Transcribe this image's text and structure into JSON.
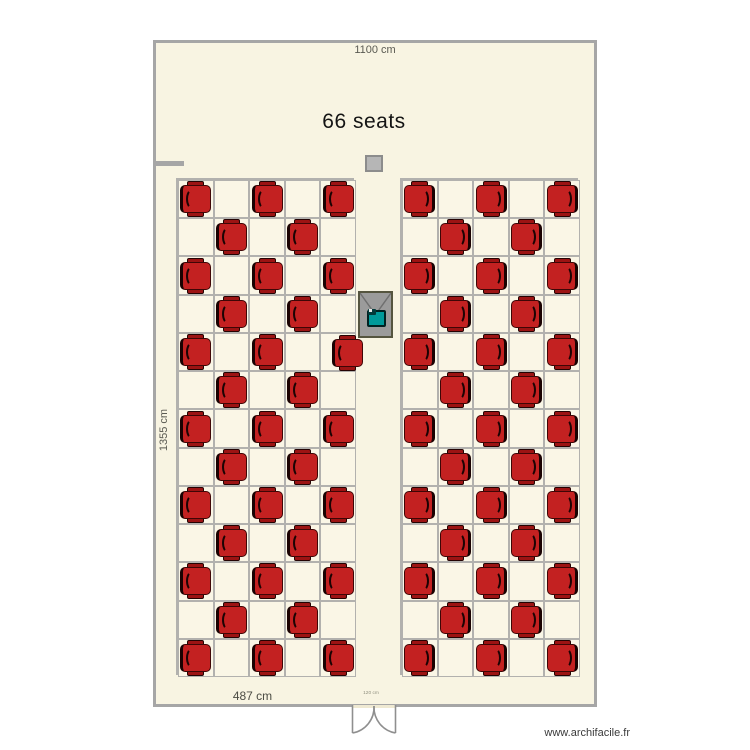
{
  "title": "66 seats",
  "seat_count": 66,
  "dimensions": {
    "top_width": "1100 cm",
    "left_height": "1355 cm",
    "bottom_block_width": "487 cm",
    "door_width": "120 cm"
  },
  "watermark": "www.archifacile.fr",
  "icons": {
    "chair": "chair-seat-icon",
    "desk": "lecturer-desk-icon",
    "laptop": "laptop-icon",
    "column": "column-icon",
    "door": "double-door-icon"
  },
  "colors": {
    "floor": "#f8f4e2",
    "wall": "#a6a6a6",
    "grid_line": "#b2b1ae",
    "seat_red": "#c32121",
    "seat_dark_red": "#9c1313",
    "seat_outline": "#2a0404",
    "desk_gray": "#9b9b9b",
    "laptop_teal": "#009a9a",
    "column_gray": "#b6b6b6"
  },
  "floorplan": {
    "room": {
      "x": 153,
      "y": 40,
      "w": 444,
      "h": 667
    },
    "grids": [
      {
        "x": 176,
        "y": 178,
        "w": 178,
        "h": 497,
        "cols": 5,
        "rows": 13,
        "facing": "right"
      },
      {
        "x": 400,
        "y": 178,
        "w": 178,
        "h": 497,
        "cols": 5,
        "rows": 13,
        "facing": "left"
      }
    ],
    "seat_pattern": {
      "even_row_cols": [
        0,
        2,
        4
      ],
      "odd_row_cols": [
        1,
        3
      ]
    },
    "seat_offsets": [
      {
        "grid": 0,
        "row": 4,
        "col": 4,
        "dx": 9,
        "dy": 1
      }
    ],
    "seats_per_grid": 33
  }
}
